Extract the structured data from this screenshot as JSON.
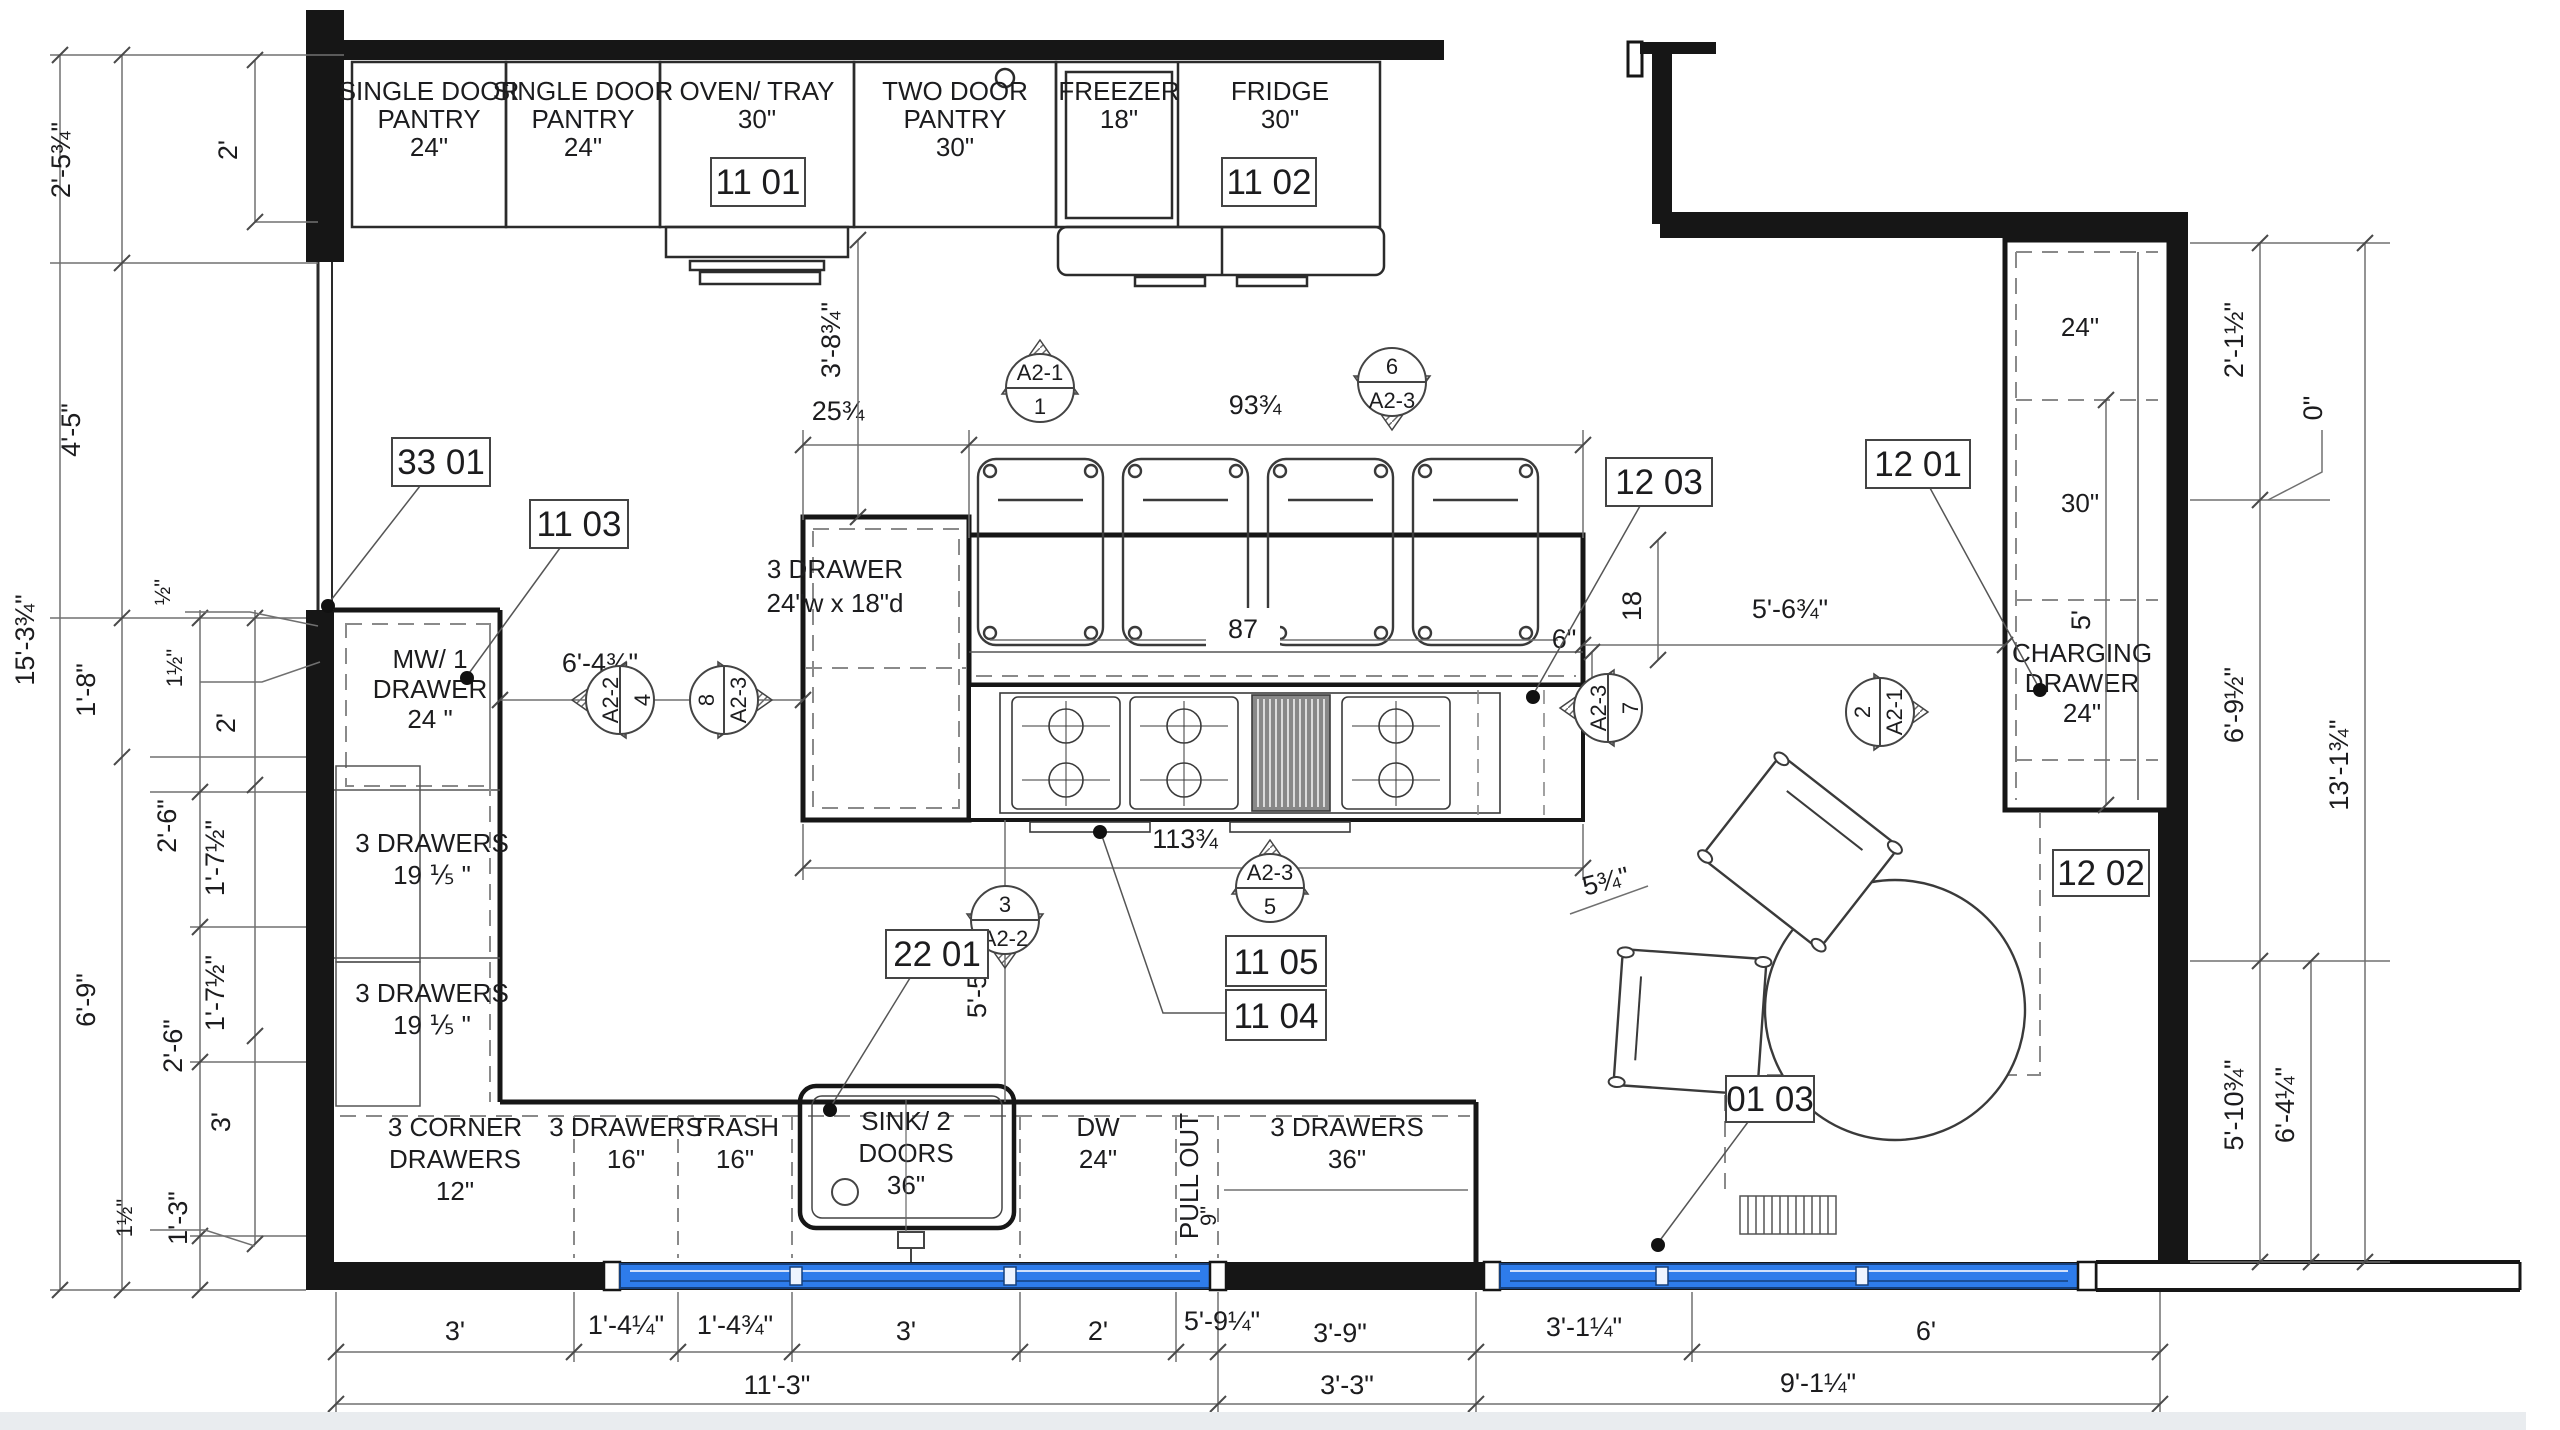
{
  "upper": {
    "p1a": "SINGLE DOOR",
    "p1b": "PANTRY",
    "p1c": "24\"",
    "p2a": "SINGLE DOOR",
    "p2b": "PANTRY",
    "p2c": "24\"",
    "ova": "OVEN/ TRAY",
    "ovb": "30\"",
    "tda": "TWO DOOR",
    "tdb": "PANTRY",
    "tdc": "30\"",
    "fza": "FREEZER",
    "fzb": "18\"",
    "fra": "FRIDGE",
    "frb": "30\""
  },
  "left": {
    "mwa": "MW/ 1",
    "mwb": "DRAWER",
    "mwc": "24 \"",
    "d1a": "3 DRAWERS",
    "d1b": "19 ⅕ \"",
    "d2a": "3 DRAWERS",
    "d2b": "19 ⅕ \""
  },
  "bottom": {
    "c1a": "3 CORNER",
    "c1b": "DRAWERS",
    "c1c": "12\"",
    "c2a": "3 DRAWERS",
    "c2b": "16\"",
    "c3a": "TRASH",
    "c3b": "16\"",
    "c4a": "SINK/ 2",
    "c4b": "DOORS",
    "c4c": "36\"",
    "c5a": "DW",
    "c5b": "24\"",
    "c6a": "PULL OUT",
    "c6b": "9\"",
    "c7a": "3 DRAWERS",
    "c7b": "36\""
  },
  "island": {
    "a": "3 DRAWER",
    "b": "24\"w x 18\"d"
  },
  "right": {
    "s1": "24\"",
    "s2": "30\"",
    "cha": "CHARGING",
    "chb": "DRAWER",
    "chc": "24\""
  },
  "tags": {
    "t3301": "33 01",
    "t1103": "11 03",
    "t1101": "11 01",
    "t1102": "11 02",
    "t1203": "12 03",
    "t1201": "12 01",
    "t1202": "12 02",
    "t2201": "22 01",
    "t1105": "11 05",
    "t1104": "11 04",
    "t0103": "01 03"
  },
  "mk": {
    "m1a": "A2-1",
    "m1b": "1",
    "m2a": "6",
    "m2b": "A2-3",
    "m3a": "A2-2",
    "m3b": "4",
    "m4a": "A2-3",
    "m4b": "8",
    "m5a": "3",
    "m5b": "A2-2",
    "m6a": "A2-3",
    "m6b": "5",
    "m7a": "A2-3",
    "m7b": "7",
    "m8a": "A2-1",
    "m8b": "2"
  },
  "dim": {
    "l1": "2'-5¾\"",
    "l2": "2'",
    "l3": "4'-5\"",
    "l4": "½\"",
    "l5": "1½\"",
    "l6": "1'-8\"",
    "l7": "2'",
    "l8": "15'-3¾\"",
    "l9": "2'-6\"",
    "l10": "1'-7½\"",
    "l11": "1'-7½\"",
    "l12": "2'-6\"",
    "l13": "6'-9\"",
    "l14": "3'",
    "l15": "1½\"",
    "l16": "1'-3\"",
    "r1": "2'-1½\"",
    "r2": "0\"",
    "r3": "6'-9½\"",
    "r4": "13'-1¾\"",
    "r5": "5'-10¾\"",
    "r6": "6'-4¼\"",
    "b1": "3'",
    "b2": "1'-4¼\"",
    "b3": "1'-4¾\"",
    "b4": "3'",
    "b5": "2'",
    "b6": "5'-9¼\"",
    "b7": "3'-9\"",
    "b8": "3'-1¼\"",
    "b9": "6'",
    "b10": "11'-3\"",
    "b11": "3'-3\"",
    "b12": "9'-1¼\"",
    "c1": "6'-4¾\"",
    "c2": "5'-6¾\"",
    "c3": "5'-5¼\"",
    "c4": "113¾",
    "c5": "25¾",
    "c6": "93¾",
    "c7": "87",
    "c8": "6\"",
    "c9": "18",
    "c10": "3'-8¾\"",
    "c11": "5'",
    "c12": "5¾\"",
    "c13": "9\""
  },
  "colors": {
    "window_blue": "#2e7ceb",
    "line_dark": "#161616",
    "dim_gray": "#707070"
  }
}
